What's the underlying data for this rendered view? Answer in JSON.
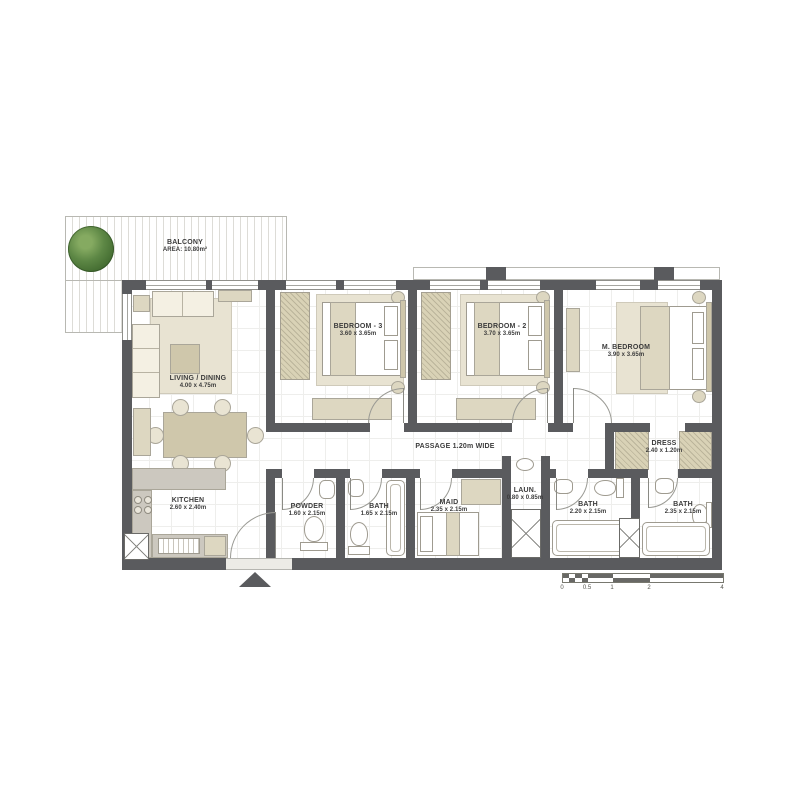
{
  "rooms": {
    "balcony": {
      "name": "BALCONY",
      "dims": "AREA: 10.80m²"
    },
    "living": {
      "name": "LIVING / DINING",
      "dims": "4.00 x 4.75m"
    },
    "bedroom3": {
      "name": "BEDROOM - 3",
      "dims": "3.60 x 3.65m"
    },
    "bedroom2": {
      "name": "BEDROOM - 2",
      "dims": "3.70 x 3.65m"
    },
    "mbedroom": {
      "name": "M. BEDROOM",
      "dims": "3.90 x 3.65m"
    },
    "passage": {
      "name": "PASSAGE 1.20m WIDE"
    },
    "dress": {
      "name": "DRESS",
      "dims": "2.40 x 1.20m"
    },
    "kitchen": {
      "name": "KITCHEN",
      "dims": "2.60 x 2.40m"
    },
    "powder": {
      "name": "POWDER",
      "dims": "1.60 x 2.15m"
    },
    "bath1": {
      "name": "BATH",
      "dims": "1.65 x 2.15m"
    },
    "maid": {
      "name": "MAID",
      "dims": "2.35 x 2.15m"
    },
    "laundry": {
      "name": "LAUN.",
      "dims": "0.80 x 0.85m"
    },
    "bath2": {
      "name": "BATH",
      "dims": "2.20 x 2.15m"
    },
    "bath3": {
      "name": "BATH",
      "dims": "2.35 x 2.15m"
    }
  },
  "scale_bar": {
    "ticks": [
      "0",
      "0.5",
      "1",
      "2",
      "4"
    ]
  },
  "colors": {
    "wall": "#5a5b5e",
    "furniture_beige": "#ddd7c1",
    "rug": "#e8e3d2",
    "tree_green": "#4e7c3c",
    "floor_grid": "#eeeeec"
  }
}
